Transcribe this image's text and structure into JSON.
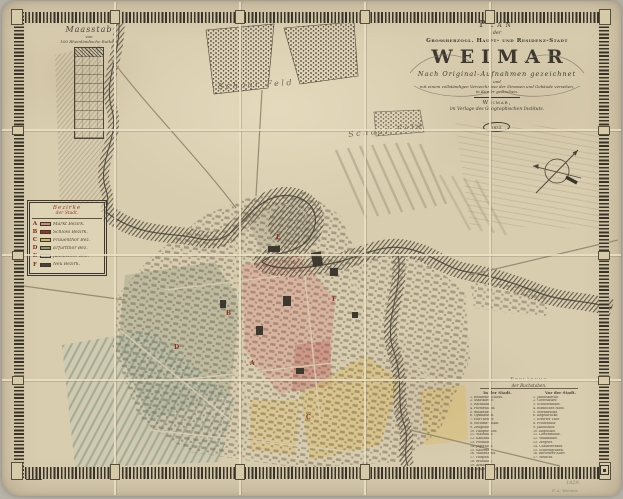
{
  "cartouche": {
    "plan": "Plan",
    "der": "der",
    "subtitle": "Großherzogl. Haupt- und Residenz-Stadt",
    "city": "WEIMAR",
    "drawn": "Nach Original-Aufnahmen gezeichnet",
    "und": "und",
    "verzeichniss": "mit einem vollständigen Verzeichnisse der Strassen und Gebäude versehen,",
    "kupfer": "in Kupfer gestochen.",
    "place": "Weimar,",
    "publisher": "im Verlage des Geographischen Instituts.",
    "year": "1833."
  },
  "scale": {
    "title": "Maasstab",
    "von": "von",
    "unit": "100 Rheinländische Ruthen."
  },
  "district_legend": {
    "title1": "Bezirke",
    "title2": "der Stadt.",
    "items": [
      {
        "letter": "A",
        "color": "#cf8878",
        "name": "Markt Bezirk."
      },
      {
        "letter": "B",
        "color": "#9e2f22",
        "name": "Schloss Bezirk."
      },
      {
        "letter": "C",
        "color": "#d3b355",
        "name": "Frauenthor Bez."
      },
      {
        "letter": "D",
        "color": "#8d9c66",
        "name": "Erfurtthor Bez."
      },
      {
        "letter": "E",
        "color": "#c2cfc9",
        "name": "Jakobsthor Bez."
      },
      {
        "letter": "F",
        "color": "#46433a",
        "name": "Neu Bezirk."
      }
    ]
  },
  "index_legend": {
    "title1": "Erklärung",
    "title2": "der Buchstaben.",
    "left_header": "In der Stadt.",
    "right_header": "Vor der Stadt.",
    "left_items": [
      "1. Residenz-Schloss.",
      "2. Stadtkirche.",
      "3. Rathhaus.",
      "4. Fürstenhaus.",
      "5. Bibliothek.",
      "6. Gymnasium.",
      "7. Hof-Theater.",
      "8. Wittums-Palais.",
      "9. Zeughaus.",
      "10. Hauptwache.",
      "11. Stadthaus.",
      "12. Kaufhaus.",
      "13. Posthaus.",
      "14. Jägerhaus.",
      "15. Kaserne.",
      "16. Waisenhaus.",
      "17. Hospital.",
      "18. Brauhaus.",
      "19. Armenhaus.",
      "20. Schiesshaus."
    ],
    "right_items": [
      "1. Jakobskirche.",
      "2. Gottesacker.",
      "3. Schützenhaus.",
      "4. Römisches Haus.",
      "5. Sternbrücke.",
      "6. Kegelbrücke.",
      "7. Erfurter Thor.",
      "8. Frauenthor.",
      "9. Jakobsthor.",
      "10. Kegelthor.",
      "11. Lottenmühle.",
      "12. Walkmühle.",
      "13. Ziegelei.",
      "14. Chausseehaus.",
      "15. Schiessgraben.",
      "16. Belvedere-Allee.",
      "17. Webicht."
    ]
  },
  "field_labels": [
    {
      "text": "Schaar Feld"
    },
    {
      "text": "Schaar Feld"
    }
  ],
  "margin_notes": {
    "note1": "1829.",
    "note2": "F. A. Weimar."
  },
  "icons": {
    "compass": "compass-rose-icon"
  },
  "colors": {
    "paper": "#d9cdb0",
    "border_ink": "#37322a",
    "ink": "#423d33",
    "river_ink": "#55503f",
    "accent_red": "#9e2f22"
  }
}
